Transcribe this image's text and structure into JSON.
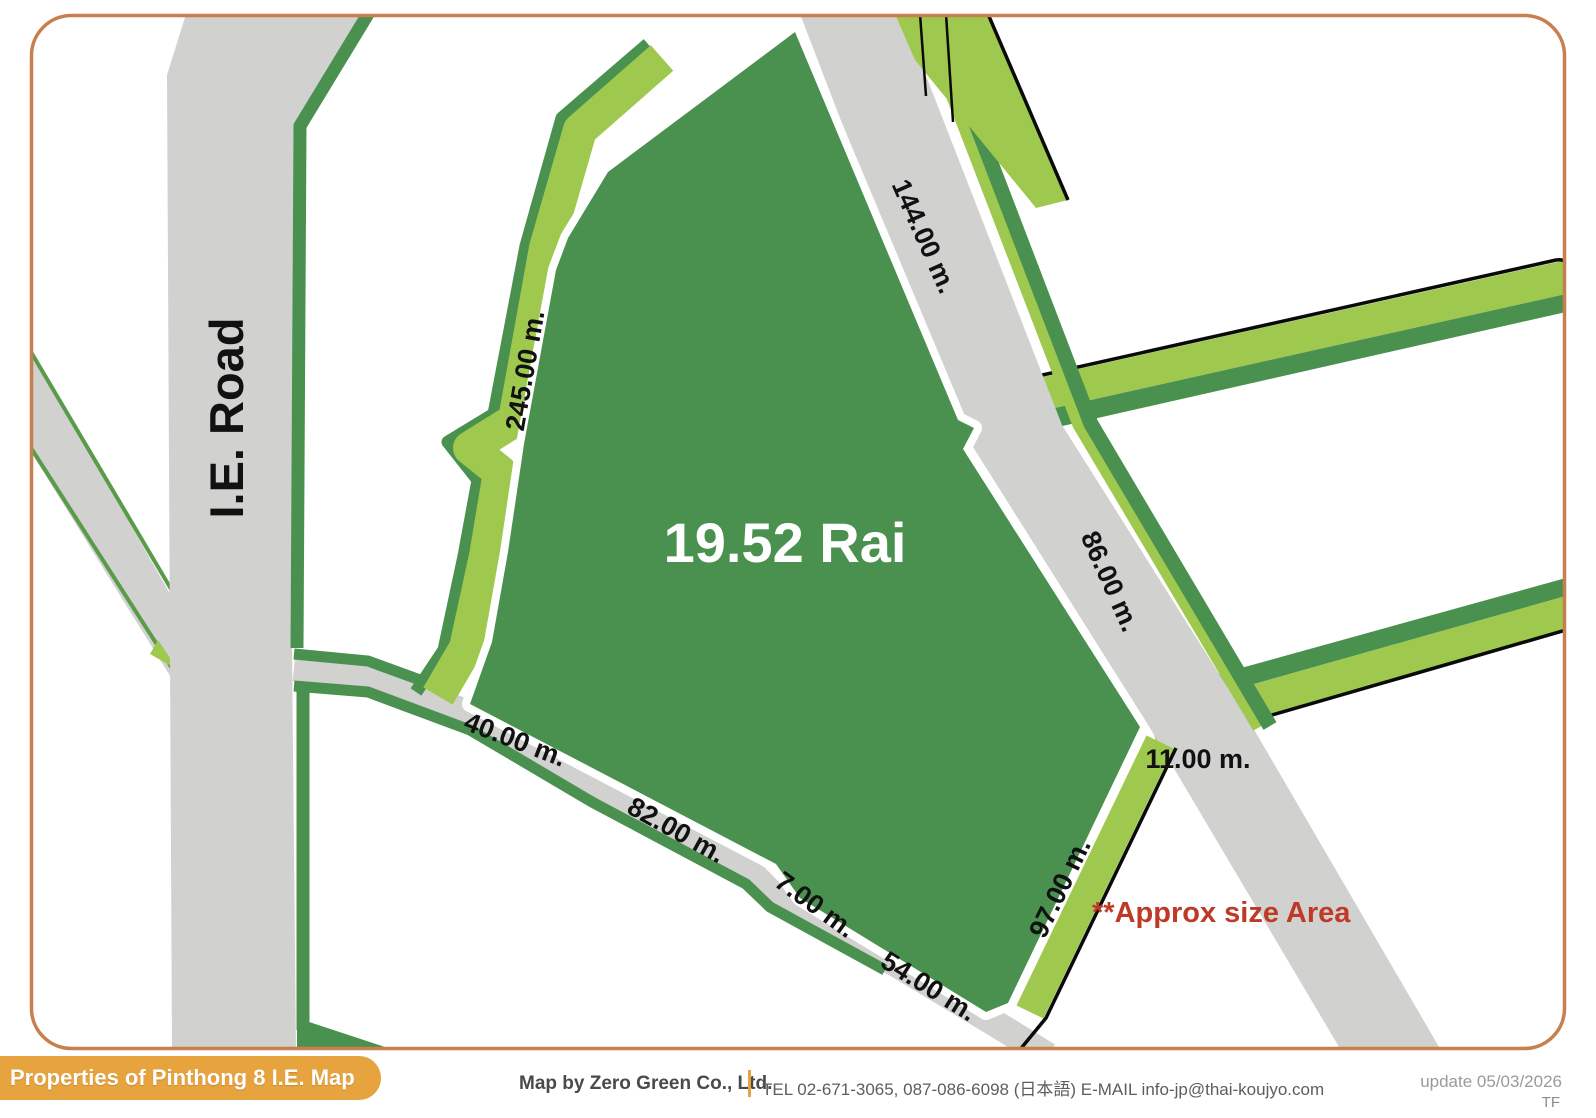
{
  "title_badge": "Properties of Pinthong 8 I.E. Map",
  "map": {
    "road_label": "I.E. Road",
    "parcel": {
      "area_label": "19.52 Rai"
    },
    "note": "**Approx size Area",
    "measurements": {
      "side_144": "144.00 m.",
      "side_86": "86.00 m.",
      "side_245": "245.00 m.",
      "side_40": "40.00 m.",
      "side_82": "82.00 m.",
      "side_7": "7.00 m.",
      "side_54": "54.00 m.",
      "side_97": "97.00 m.",
      "side_11": "11.00 m."
    },
    "colors": {
      "parcel_green": "#4a9150",
      "verge_light_green": "#9fc94e",
      "road_gray": "#d1d1d0",
      "border_orange": "#c87f4e",
      "badge_orange": "#e7a33e",
      "note_red": "#bf3a26",
      "outline_black": "#0a0a0a"
    }
  },
  "footer": {
    "credit": "Map by Zero Green Co., Ltd.",
    "contact": "TEL 02-671-3065, 087-086-6098 (日本語) E-MAIL info-jp@thai-koujyo.com",
    "update": "update 05/03/2026",
    "initials": "TF"
  }
}
